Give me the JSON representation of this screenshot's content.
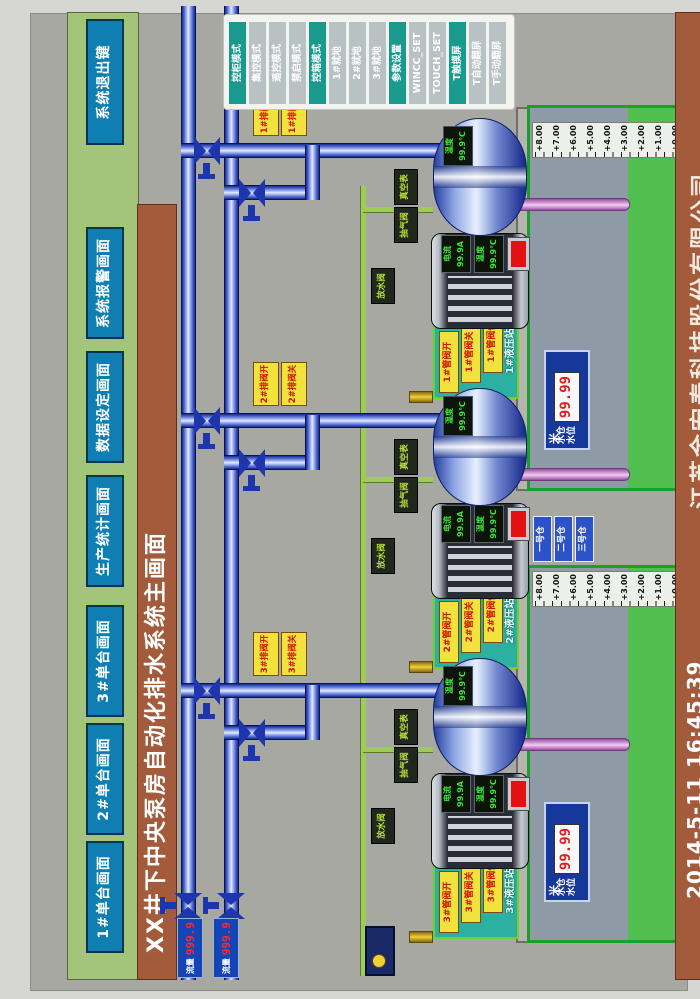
{
  "title": "XX井下中央泵房自动化排水系统主画面",
  "menu": {
    "items": [
      "1#单台画面",
      "2#单台画面",
      "3#单台画面",
      "生产统计画面",
      "数据设定画面",
      "系统报警画面"
    ],
    "exit_label": "系统退出键"
  },
  "side_panel": {
    "buttons": [
      {
        "label": "控柜模式"
      },
      {
        "label": "集控模式"
      },
      {
        "label": "遥控模式"
      },
      {
        "label": "禁启模式"
      },
      {
        "label": "控箱模式"
      },
      {
        "label": "1#就地"
      },
      {
        "label": "2#就地"
      },
      {
        "label": "3#就地"
      },
      {
        "label": "参数设置"
      },
      {
        "label": "WINCC_SET"
      },
      {
        "label": "TOUCH_SET"
      },
      {
        "label": "T触摸屏"
      },
      {
        "label": "T自动翻屏"
      },
      {
        "label": "T手动翻屏"
      }
    ]
  },
  "footer": {
    "datetime": "2014-5-11  16:45:39",
    "company": "江苏金宏泰科技股份有限公司"
  },
  "flow_meters": [
    {
      "label": "流量",
      "value": "999.9"
    },
    {
      "label": "流量",
      "value": "999.9"
    }
  ],
  "units": [
    {
      "id": "1#",
      "valve_open": "1#排阀开",
      "valve_closed": "1#排阀关",
      "pump_temp_label": "温度",
      "pump_temp_value": "99.9℃",
      "motor_current_label": "电流",
      "motor_current_value": "99.9A",
      "motor_temp_label": "温度",
      "motor_temp_value": "99.9℃",
      "station": {
        "name": "1#液压站",
        "labels": [
          "1#管阀开",
          "1#管阀关",
          "1#管阀停"
        ]
      }
    },
    {
      "id": "2#",
      "valve_open": "2#排阀开",
      "valve_closed": "2#排阀关",
      "pump_temp_label": "温度",
      "pump_temp_value": "99.9℃",
      "motor_current_label": "电流",
      "motor_current_value": "99.9A",
      "motor_temp_label": "温度",
      "motor_temp_value": "99.9℃",
      "station": {
        "name": "2#液压站",
        "labels": [
          "2#管阀开",
          "2#管阀关",
          "2#管阀停"
        ]
      }
    },
    {
      "id": "3#",
      "valve_open": "3#排阀开",
      "valve_closed": "3#排阀关",
      "pump_temp_label": "温度",
      "pump_temp_value": "99.9℃",
      "motor_current_label": "电流",
      "motor_current_value": "99.9A",
      "motor_temp_label": "温度",
      "motor_temp_value": "99.9℃",
      "station": {
        "name": "3#液压站",
        "labels": [
          "3#管阀开",
          "3#管阀关",
          "3#管阀停"
        ]
      }
    }
  ],
  "pipe_labels": {
    "drain": "放水阀",
    "vacuum_valve": "抽气阀",
    "vacuum_gauge": "真空表"
  },
  "sumps": [
    {
      "level_label_line1": "水仓",
      "level_label_line2": "水位",
      "value": "99.99",
      "unit": "米"
    },
    {
      "level_label_line1": "水仓",
      "level_label_line2": "水位",
      "value": "99.99",
      "unit": "米"
    }
  ],
  "sump_scale": [
    "+8.00",
    "+7.00",
    "+6.00",
    "+5.00",
    "+4.00",
    "+3.00",
    "+2.00",
    "+1.00",
    "+0.00"
  ],
  "sump_buttons": [
    "一号仓",
    "二号仓",
    "三号仓"
  ],
  "colors": {
    "accent_teal": "#1a998f",
    "menu_blue": "#0f7fb3",
    "bar_brown": "#a35b3b",
    "bar_green": "#a3c57a",
    "alarm_red": "#e31111",
    "water_green": "#50bf50"
  }
}
